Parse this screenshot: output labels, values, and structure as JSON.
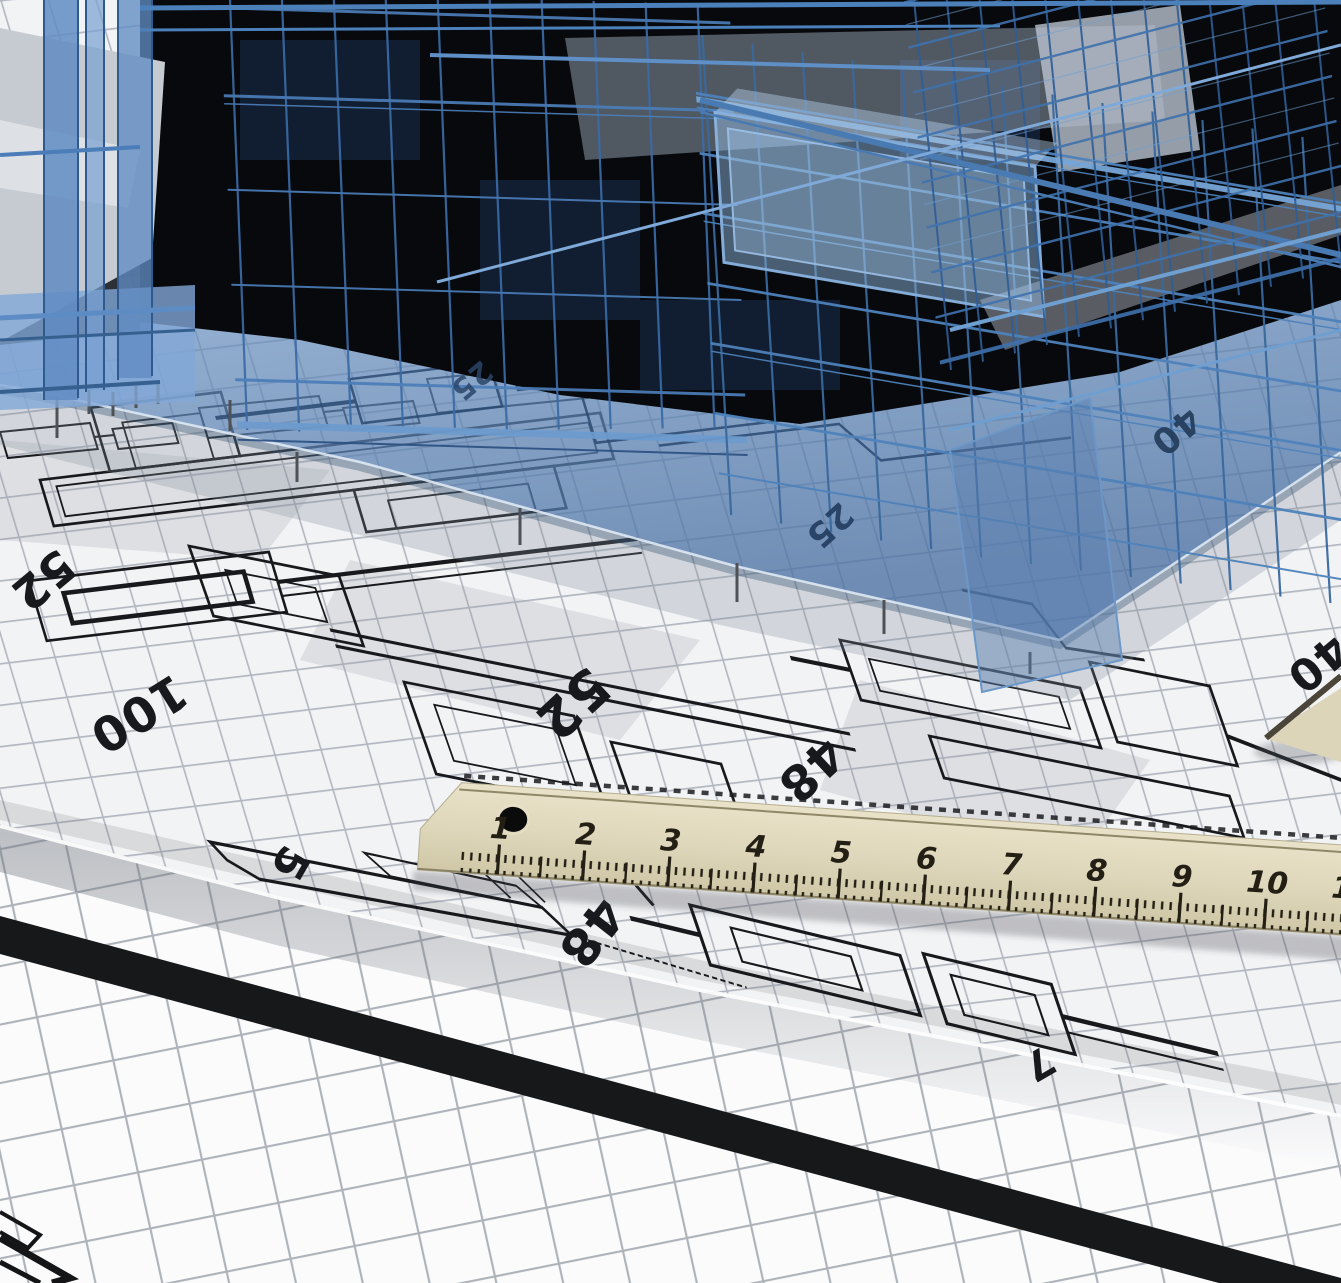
{
  "blueprint": {
    "annotations": [
      {
        "text": "52"
      },
      {
        "text": "100"
      },
      {
        "text": "52"
      },
      {
        "text": "48"
      },
      {
        "text": "40"
      },
      {
        "text": "25"
      },
      {
        "text": "25"
      },
      {
        "text": "5"
      },
      {
        "text": "48"
      },
      {
        "text": "7"
      },
      {
        "text": "40"
      }
    ]
  },
  "ruler": {
    "numbers": [
      "1",
      "2",
      "3",
      "4",
      "5",
      "6",
      "7",
      "8",
      "9",
      "10",
      "11"
    ]
  },
  "colors": {
    "paper": "#f2f3f5",
    "grid_line": "#b2b7c0",
    "roll_grid_line": "#aeb3ba",
    "plan_line": "#17191c",
    "wireframe_blue": "#3f74b4",
    "wireframe_light": "#7aa6d8",
    "glass_blue": "#8fb4dd",
    "slab_blue": "#5f8cc0",
    "void_dark": "#07090c",
    "ruler_wood": "#ddd6ba",
    "ruler_marking": "#241f15",
    "roll_band_black": "#17181a"
  }
}
